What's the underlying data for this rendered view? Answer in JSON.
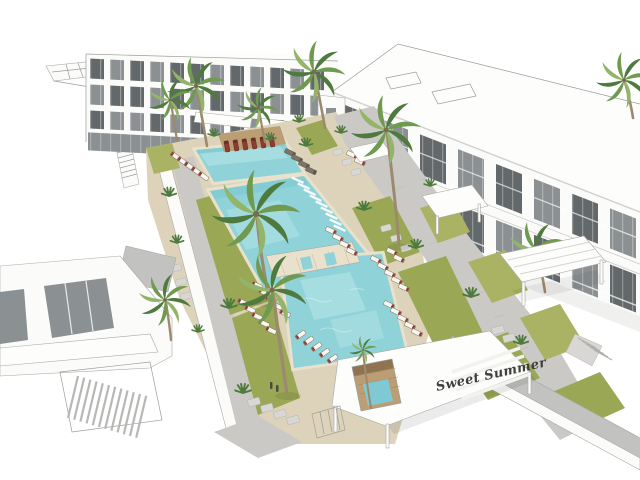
{
  "meta": {
    "type": "architectural-rendering",
    "style": "3d-sketchup-concept",
    "view": "aerial view of resort apartment courtyard with pools"
  },
  "labels": {
    "canopy_text": "Sweet Summer"
  },
  "palette": {
    "bg": "#ffffff",
    "line": "#9c9c9a",
    "wall_white": "#fbfbfa",
    "wall_shade": "#ededeb",
    "roof_white": "#fdfdfc",
    "glass_dark": "#63696b",
    "glass_mid": "#8b9092",
    "glass_light": "#b7bcbc",
    "concrete": "#c2c2c0",
    "path_gray": "#cac9c6",
    "stone_light": "#d8d7d4",
    "deck_tan": "#ddd3ba",
    "deck_light": "#e9e1cc",
    "wood": "#bb9e74",
    "wood_dark": "#8f744f",
    "pool": "#8fd2d8",
    "pool_light": "#bde8ea",
    "pool_deep": "#6fc3cc",
    "spa": "#7fc9d4",
    "grass": "#9aa855",
    "grass_light": "#aab364",
    "palm_dark": "#4e7a3e",
    "palm_mid": "#6f9a50",
    "palm_light": "#93b56a",
    "trunk": "#9b8a6d",
    "cushion_white": "#f7f6f3",
    "cushion_red": "#8e3b34",
    "frame_dark": "#857258",
    "text_dark": "#3f3f3d"
  },
  "scene": {
    "buildings": [
      "back-apartment-block",
      "right-apartment-block",
      "left-wireframe-block",
      "bottom-left-villa"
    ],
    "pools": [
      "lap-pool",
      "leisure-pool-with-in-water-loungers",
      "main-family-pool",
      "plunge-spa"
    ],
    "landscape": [
      "palm-trees",
      "lawn-panels",
      "stepping-stones",
      "cobble-walkways",
      "timber-deck"
    ],
    "furniture": [
      "white-lounge-chairs",
      "red-lounge-chairs",
      "in-pool-loungers",
      "shade-pergolas",
      "canopy-roof-with-logo"
    ]
  }
}
